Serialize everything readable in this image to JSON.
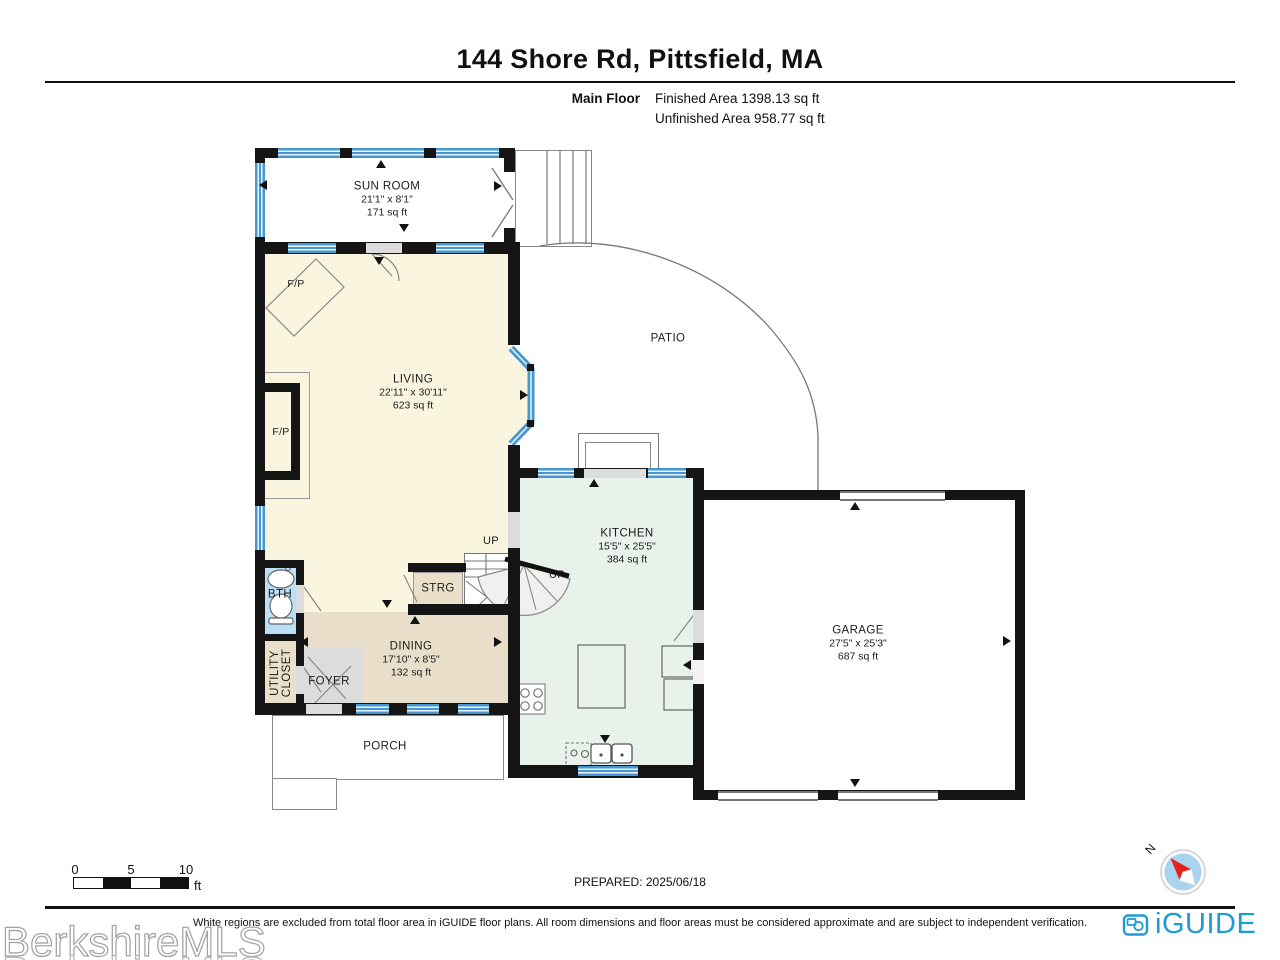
{
  "header": {
    "title": "144 Shore Rd, Pittsfield, MA",
    "floor_label": "Main Floor",
    "finished_area": "Finished Area 1398.13 sq ft",
    "unfinished_area": "Unfinished Area 958.77 sq ft"
  },
  "rooms": {
    "sun_room": {
      "name": "SUN ROOM",
      "dims": "21'1\" x 8'1\"",
      "area": "171 sq ft"
    },
    "living": {
      "name": "LIVING",
      "dims": "22'11\" x 30'11\"",
      "area": "623 sq ft"
    },
    "kitchen": {
      "name": "KITCHEN",
      "dims": "15'5\" x 25'5\"",
      "area": "384 sq ft"
    },
    "garage": {
      "name": "GARAGE",
      "dims": "27'5\" x 25'3\"",
      "area": "687 sq ft"
    },
    "dining": {
      "name": "DINING",
      "dims": "17'10\" x 8'5\"",
      "area": "132 sq ft"
    },
    "patio": {
      "name": "PATIO"
    },
    "porch": {
      "name": "PORCH"
    },
    "foyer": {
      "name": "FOYER"
    },
    "bath": {
      "name": "BTH"
    },
    "utility_closet": {
      "line1": "UTILITY",
      "line2": "CLOSET"
    },
    "storage": {
      "name": "STRG"
    }
  },
  "annotations": {
    "up": "UP",
    "fireplace": "F/P"
  },
  "scale_bar": {
    "tick0": "0",
    "tick5": "5",
    "tick10": "10",
    "unit": "ft"
  },
  "compass": {
    "north_label": "N"
  },
  "footer": {
    "prepared": "PREPARED: 2025/06/18",
    "disclaimer": "White regions are excluded from total floor area in iGUIDE floor plans. All room dimensions and floor areas must be considered approximate and are subject to independent verification.",
    "watermark": "BerkshireMLS",
    "brand": "iGUIDE"
  },
  "colors": {
    "wall": "#151515",
    "window_blue": "#4798d2",
    "living_fill": "#faf5df",
    "dining_fill": "#e8deca",
    "kitchen_fill": "#e9f1eb",
    "bath_fill": "#bbdff4",
    "foyer_fill": "#dcdcdc",
    "brand_blue": "#1d9bd5",
    "compass_fill": "#a8d4ee",
    "compass_needle": "#e8211d"
  }
}
